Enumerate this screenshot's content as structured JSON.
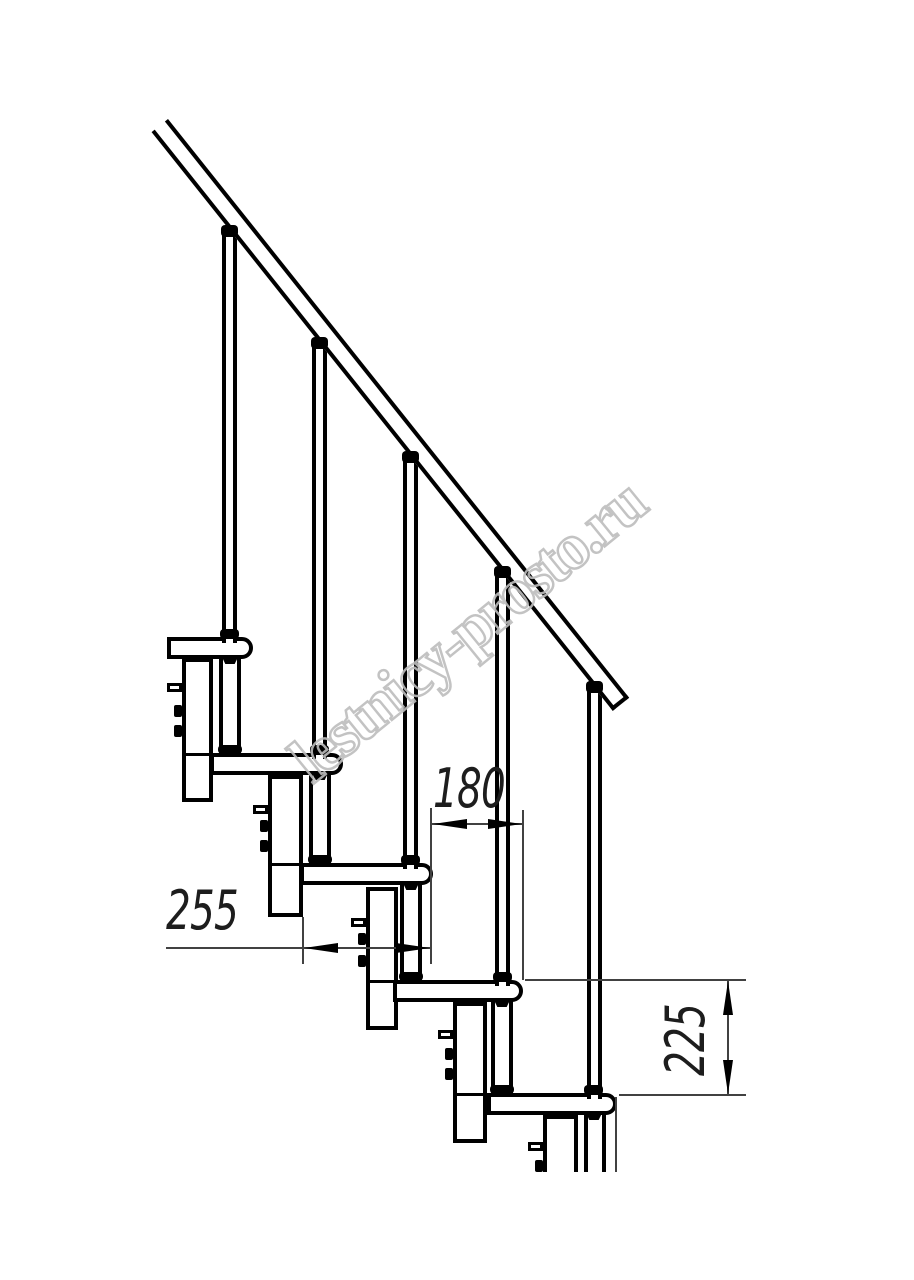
{
  "page": {
    "background": "#ffffff",
    "line_color": "#000000",
    "description": "Side-view technical line drawing of a modular staircase section with handrail, balusters, treads and support columns"
  },
  "watermark": {
    "text": "lestnicy-prosto.ru",
    "stroke_color": "#bdbdbd"
  },
  "dims": {
    "run": "180",
    "depth": "255",
    "rise": "225"
  },
  "dimension_meta": [
    {
      "label": "180",
      "orientation": "horizontal",
      "measures": "step run between tread noses"
    },
    {
      "label": "255",
      "orientation": "horizontal",
      "measures": "tread depth"
    },
    {
      "label": "225",
      "orientation": "vertical",
      "measures": "step rise between tread tops"
    }
  ],
  "structure": {
    "treads": 5,
    "balusters": 5,
    "support_columns": 5,
    "handrails": 1
  }
}
